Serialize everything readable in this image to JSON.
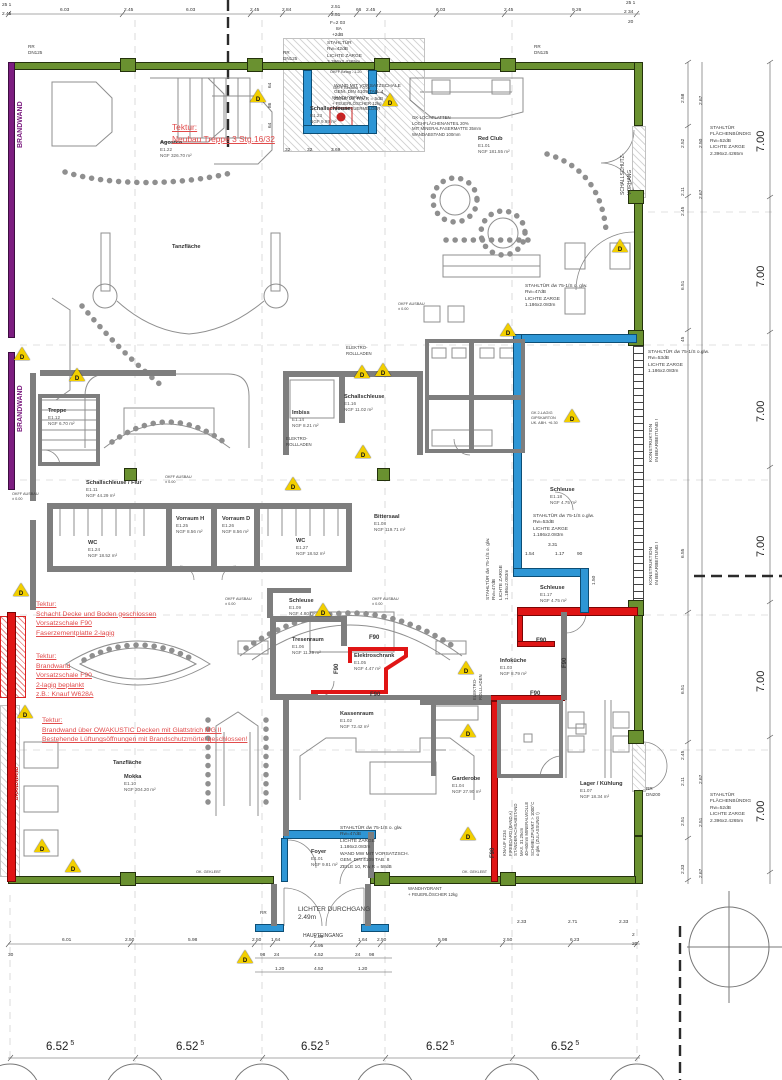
{
  "plan": {
    "colors": {
      "wall_green": "#6a9130",
      "brandwand_purple": "#7c1d80",
      "fire_red": "#e01515",
      "door_blue": "#2e96d5",
      "wall_gray": "#7e7e7e",
      "tektur_red": "#e14b4b",
      "warn_yellow": "#f2cf00"
    },
    "rooms": [
      {
        "name": "Agostea",
        "id": "E1.22",
        "area": "NGF  326.70 m²",
        "x": 160,
        "y": 140
      },
      {
        "name": "Red Club",
        "id": "E1.01",
        "area": "NGF  181.55 m²",
        "x": 478,
        "y": 136
      },
      {
        "name": "Tanzfläche",
        "id": "",
        "area": "",
        "x": 172,
        "y": 244
      },
      {
        "name": "Schallschleuse",
        "id": "E1.23",
        "area": "NGF  9.99 m²",
        "x": 310,
        "y": 106
      },
      {
        "name": "Treppe",
        "id": "E1.12",
        "area": "NGF  6.70 m²",
        "x": 48,
        "y": 408
      },
      {
        "name": "Imbiss",
        "id": "E1.14",
        "area": "NGF  8.21 m²",
        "x": 292,
        "y": 410
      },
      {
        "name": "Schallschleuse",
        "id": "E1.16",
        "area": "NGF  11.02 m²",
        "x": 344,
        "y": 394
      },
      {
        "name": "Schallschleuse / Flur",
        "id": "E1.11",
        "area": "NGF  44.29 m²",
        "x": 86,
        "y": 480
      },
      {
        "name": "Vorraum H",
        "id": "E1.25",
        "area": "NGF  8.56 m²",
        "x": 176,
        "y": 516
      },
      {
        "name": "Vorraum D",
        "id": "E1.26",
        "area": "NGF  8.56 m²",
        "x": 222,
        "y": 516
      },
      {
        "name": "WC",
        "id": "E1.24",
        "area": "NGF  18.52 m²",
        "x": 88,
        "y": 540
      },
      {
        "name": "WC",
        "id": "E1.27",
        "area": "NGF  18.52 m²",
        "x": 296,
        "y": 538
      },
      {
        "name": "Bittersaal",
        "id": "E1.08",
        "area": "NGF  119.71 m²",
        "x": 374,
        "y": 514
      },
      {
        "name": "Schleuse",
        "id": "E1.09",
        "area": "NGF  4.80 m²",
        "x": 289,
        "y": 598
      },
      {
        "name": "Schleuse",
        "id": "E1.18",
        "area": "NGF  4.75 m²",
        "x": 550,
        "y": 487
      },
      {
        "name": "Schleuse",
        "id": "E1.17",
        "area": "NGF  4.75 m²",
        "x": 540,
        "y": 585
      },
      {
        "name": "Tresenraum",
        "id": "E1.06",
        "area": "NGF  11.29 m²",
        "x": 292,
        "y": 637
      },
      {
        "name": "Elektroschrank",
        "id": "E1.05",
        "area": "NGF  4.47 m²",
        "x": 354,
        "y": 653
      },
      {
        "name": "Infoküche",
        "id": "E1.03",
        "area": "NGF  8.79 m²",
        "x": 500,
        "y": 658
      },
      {
        "name": "Kassenraum",
        "id": "E1.02",
        "area": "NGF  72.42 m²",
        "x": 340,
        "y": 711
      },
      {
        "name": "Tanzfläche",
        "id": "",
        "area": "",
        "x": 113,
        "y": 760
      },
      {
        "name": "Mokka",
        "id": "E1.10",
        "area": "NGF  204.20 m²",
        "x": 124,
        "y": 774
      },
      {
        "name": "Foyer",
        "id": "E1.01",
        "area": "NGF  9.81 m²",
        "x": 311,
        "y": 849
      },
      {
        "name": "Garderobe",
        "id": "E1.04",
        "area": "NGF  27.90 m²",
        "x": 452,
        "y": 776
      },
      {
        "name": "Lager / Kühlung",
        "id": "E1.07",
        "area": "NGF  18.34 m²",
        "x": 580,
        "y": 781
      }
    ],
    "tektur_notes": [
      {
        "x": 172,
        "y": 122,
        "big": true,
        "lines": [
          "Tektur:",
          "Neubau Treppe 3 Stg.16/32"
        ]
      },
      {
        "x": 36,
        "y": 600,
        "big": false,
        "lines": [
          "Tektur:",
          "Schacht Decke und Boden geschlossen",
          "Vorsatzschale F90",
          "Faserzementplatte 2-lagig"
        ]
      },
      {
        "x": 36,
        "y": 652,
        "big": false,
        "lines": [
          "Tektur:",
          "Brandwand",
          "Vorsatzschale F90",
          "2-lagig beplankt",
          "z.B.: Knauf W628A"
        ]
      },
      {
        "x": 42,
        "y": 716,
        "big": false,
        "lines": [
          "Tektur:",
          "Brandwand über OWAKUSTIC Decken mit Glattstrich MG II",
          "Bestehende Lüftungsöffnungen mit Brandschutzmörtel geschlossen!"
        ]
      }
    ],
    "door_specs": [
      {
        "x": 327,
        "y": 41,
        "r": 0,
        "lines": [
          "STAHLTÜR",
          "Rw=42dB",
          "LICHTE ZARGE",
          "2.396x2.4265m"
        ]
      },
      {
        "x": 710,
        "y": 126,
        "r": 0,
        "lines": [
          "STAHLTÜR",
          "FLÄCHENBÜNDIG",
          "Rw=52dB",
          "LICHTE ZARGE",
          "2.396x2.4265m"
        ]
      },
      {
        "x": 525,
        "y": 284,
        "r": 0,
        "lines": [
          "STAHLTÜR dw 75-1/S o. glw.",
          "Rw=47dB",
          "LICHTE ZARGE",
          "1.186x2.083m"
        ]
      },
      {
        "x": 648,
        "y": 350,
        "r": 0,
        "lines": [
          "STAHLTÜR dw 75-1/S o.glw.",
          "Rw=53dB",
          "LICHTE ZARGE",
          "1.186x2.083m"
        ]
      },
      {
        "x": 533,
        "y": 514,
        "r": 0,
        "lines": [
          "STAHLTÜR dw 75-1/S o.glw.",
          "Rw=53dB",
          "LICHTE ZARGE",
          "1.186x2.083m"
        ]
      },
      {
        "x": 486,
        "y": 600,
        "r": -90,
        "lines": [
          "STAHLTÜR dw 75-1/S o. glw.",
          "Rw=47dB",
          "LICHTE ZARGE",
          "1.186x2.083m"
        ]
      },
      {
        "x": 340,
        "y": 826,
        "r": 0,
        "lines": [
          "STAHLTÜR dw 75-1/S o. glw.",
          "Rw=47dB",
          "LICHTE ZARGE",
          "1.186x2.083m",
          "WAND MW MIT VORSATZSCH.",
          "GEM. DIN 4109 TAB. 8",
          "ZEILE 10, R'w,R = 58dB"
        ]
      },
      {
        "x": 710,
        "y": 793,
        "r": 0,
        "lines": [
          "STAHLTÜR",
          "FLÄCHENBÜNDIG",
          "Rw=52dB",
          "LICHTE ZARGE",
          "2.396x2.4265m"
        ]
      },
      {
        "x": 334,
        "y": 84,
        "r": 0,
        "lines": [
          "WAND MIT VORSATZSCHALE",
          "GEM. DIN 4109 TAB. 4",
          "ZEILE 10, R'w,R = 5dB"
        ]
      }
    ],
    "misc_labels": [
      {
        "lines": [
          "RR",
          "DN125"
        ],
        "x": 28,
        "y": 44,
        "r": 0,
        "c": "",
        "s": 4.6
      },
      {
        "lines": [
          "RR",
          "DN125"
        ],
        "x": 283,
        "y": 50,
        "r": 0,
        "c": "",
        "s": 4.6
      },
      {
        "lines": [
          "RR",
          "DN125"
        ],
        "x": 534,
        "y": 44,
        "r": 0,
        "c": "",
        "s": 4.6
      },
      {
        "lines": [
          "RR",
          "DN200"
        ],
        "x": 646,
        "y": 786,
        "r": 0,
        "c": "",
        "s": 4.6
      },
      {
        "lines": [
          "RR"
        ],
        "x": 260,
        "y": 910,
        "r": 0,
        "c": "",
        "s": 4.6
      },
      {
        "lines": [
          "LICHTER DURCHGANG",
          "2.49m"
        ],
        "x": 298,
        "y": 906,
        "r": 0,
        "c": "",
        "s": 6.5
      },
      {
        "lines": [
          "HAUPTEINGANG"
        ],
        "x": 303,
        "y": 933,
        "r": 0,
        "c": "",
        "s": 5
      },
      {
        "lines": [
          "WANDHYDRANT",
          "+ FEUERLÖSCHER 12kg"
        ],
        "x": 408,
        "y": 886,
        "r": 0,
        "c": "",
        "s": 4.3
      },
      {
        "lines": [
          "WANDHYDRANT",
          "+ FEUERLÖSCHER 12kg",
          "+ HANDFEUERMELDER"
        ],
        "x": 332,
        "y": 95,
        "r": 0,
        "c": "",
        "s": 4.3
      },
      {
        "lines": [
          "GK-LOCHPLATTEN",
          "LOCHFLÄCHENANTEIL 20%",
          "MIT MINERALFASERMATTE 35mm",
          "WANDABSTAND 100mm"
        ],
        "x": 412,
        "y": 115,
        "r": 0,
        "c": "",
        "s": 4.3
      },
      {
        "lines": [
          "ELEKTRO-",
          "ROLLLADEN"
        ],
        "x": 346,
        "y": 345,
        "r": 0,
        "c": "",
        "s": 4.3
      },
      {
        "lines": [
          "ELEKTRO-",
          "ROLLLADEN"
        ],
        "x": 286,
        "y": 436,
        "r": 0,
        "c": "",
        "s": 4.3
      },
      {
        "lines": [
          "ELEKTRO-",
          "ROLLLADEN"
        ],
        "x": 472,
        "y": 700,
        "r": -90,
        "c": "",
        "s": 4.3
      },
      {
        "lines": [
          "SCHALLSCHUTZ-",
          "VORHANG"
        ],
        "x": 620,
        "y": 195,
        "r": -90,
        "c": "",
        "s": 5
      },
      {
        "lines": [
          "KONSTRUKTION",
          "IN BEARBEITUNG !"
        ],
        "x": 649,
        "y": 462,
        "r": -90,
        "c": "",
        "s": 4.8
      },
      {
        "lines": [
          "KONSTRUKTION",
          "IN BEARBEITUNG !"
        ],
        "x": 649,
        "y": 585,
        "r": -90,
        "c": "",
        "s": 4.8
      },
      {
        "lines": [
          "BRANDWAND"
        ],
        "x": 16,
        "y": 148,
        "r": -90,
        "c": "#7c1d80",
        "s": 7
      },
      {
        "lines": [
          "BRANDWAND"
        ],
        "x": 16,
        "y": 432,
        "r": -90,
        "c": "#7c1d80",
        "s": 7
      },
      {
        "lines": [
          "BRANDWAND"
        ],
        "x": 14,
        "y": 800,
        "r": -90,
        "c": "#d01414",
        "s": 5
      },
      {
        "lines": [
          "OK. GEKLEBT"
        ],
        "x": 196,
        "y": 870,
        "r": 0,
        "c": "",
        "s": 3.8
      },
      {
        "lines": [
          "OK. GEKLEBT"
        ],
        "x": 462,
        "y": 870,
        "r": 0,
        "c": "",
        "s": 3.8
      },
      {
        "lines": [
          "OKFF AUSBAU",
          "± 0.00"
        ],
        "x": 165,
        "y": 475,
        "r": 0,
        "c": "",
        "s": 3.8
      },
      {
        "lines": [
          "OKFF AUSBAU",
          "± 0.00"
        ],
        "x": 12,
        "y": 492,
        "r": 0,
        "c": "",
        "s": 3.8
      },
      {
        "lines": [
          "OKFF AUSBAU",
          "± 0.00"
        ],
        "x": 225,
        "y": 597,
        "r": 0,
        "c": "",
        "s": 3.8
      },
      {
        "lines": [
          "OKFF AUSBAU",
          "± 0.00"
        ],
        "x": 372,
        "y": 597,
        "r": 0,
        "c": "",
        "s": 3.8
      },
      {
        "lines": [
          "OKFF AUSBAU",
          "± 0.00"
        ],
        "x": 398,
        "y": 302,
        "r": 0,
        "c": "",
        "s": 3.8
      },
      {
        "lines": [
          "OKFF Belag  - 1.20"
        ],
        "x": 330,
        "y": 70,
        "r": 0,
        "c": "",
        "s": 3.8
      },
      {
        "lines": [
          "OKFF Bestand  + 0.06"
        ],
        "x": 333,
        "y": 86,
        "r": 0,
        "c": "",
        "s": 3.8
      },
      {
        "lines": [
          "GK 2-LAGIG",
          "GIPSKARTON",
          "UK. ABH. +6.30"
        ],
        "x": 531,
        "y": 411,
        "r": 0,
        "c": "",
        "s": 3.8
      },
      {
        "lines": [
          "KNAUF K234",
          "FIREBOARD (BAND A)",
          "STÄNDERACHSABSTAND",
          "MAX. 31.25cm",
          "40+60mm MINERALWOLLE",
          "SCHMELZPUNKT > 1000°C",
          "o.glw. (ZULASSUNG !)"
        ],
        "x": 502,
        "y": 856,
        "r": -90,
        "c": "",
        "s": 4.3
      }
    ],
    "f90": {
      "text": "F90",
      "items": [
        {
          "x": 369,
          "y": 635,
          "r": 0
        },
        {
          "x": 334,
          "y": 674,
          "r": -90
        },
        {
          "x": 370,
          "y": 692,
          "r": 0
        },
        {
          "x": 536,
          "y": 638,
          "r": 0
        },
        {
          "x": 530,
          "y": 691,
          "r": 0
        },
        {
          "x": 562,
          "y": 668,
          "r": -90
        },
        {
          "x": 490,
          "y": 858,
          "r": -90
        }
      ]
    },
    "warn": {
      "letter": "D",
      "items": [
        [
          258,
          96
        ],
        [
          390,
          100
        ],
        [
          22,
          354
        ],
        [
          77,
          375
        ],
        [
          362,
          372
        ],
        [
          383,
          370
        ],
        [
          620,
          246
        ],
        [
          508,
          330
        ],
        [
          572,
          416
        ],
        [
          363,
          452
        ],
        [
          293,
          484
        ],
        [
          21,
          590
        ],
        [
          323,
          610
        ],
        [
          466,
          668
        ],
        [
          25,
          712
        ],
        [
          468,
          731
        ],
        [
          42,
          846
        ],
        [
          73,
          866
        ],
        [
          468,
          834
        ],
        [
          245,
          957
        ]
      ]
    },
    "dims": [
      {
        "t": "25 1",
        "x": 2,
        "y": 3
      },
      {
        "t": "2.45",
        "x": 2,
        "y": 12
      },
      {
        "t": "6.03",
        "x": 60,
        "y": 8
      },
      {
        "t": "2.45",
        "x": 124,
        "y": 8
      },
      {
        "t": "6.03",
        "x": 186,
        "y": 8
      },
      {
        "t": "2.45",
        "x": 250,
        "y": 8
      },
      {
        "t": "2.84",
        "x": 282,
        "y": 8
      },
      {
        "t": "2.51",
        "x": 331,
        "y": 5
      },
      {
        "t": "2.51",
        "x": 331,
        "y": 13
      },
      {
        "t": "F=2 03",
        "x": 330,
        "y": 21
      },
      {
        "t": "8A",
        "x": 336,
        "y": 27
      },
      {
        "t": "+2dB",
        "x": 332,
        "y": 33
      },
      {
        "t": "66",
        "x": 356,
        "y": 8
      },
      {
        "t": "2.45",
        "x": 366,
        "y": 8
      },
      {
        "t": "6.03",
        "x": 436,
        "y": 8
      },
      {
        "t": "2.45",
        "x": 504,
        "y": 8
      },
      {
        "t": "9.26",
        "x": 572,
        "y": 8
      },
      {
        "t": "25 1",
        "x": 626,
        "y": 1
      },
      {
        "t": "2 34",
        "x": 624,
        "y": 10
      },
      {
        "t": "20",
        "x": 628,
        "y": 20
      },
      {
        "t": "6.01",
        "x": 62,
        "y": 938
      },
      {
        "t": "2.50",
        "x": 125,
        "y": 938
      },
      {
        "t": "5.98",
        "x": 188,
        "y": 938
      },
      {
        "t": "2.50",
        "x": 252,
        "y": 938
      },
      {
        "t": "1.64",
        "x": 271,
        "y": 938
      },
      {
        "t": "2.69",
        "x": 314,
        "y": 935
      },
      {
        "t": "3.95",
        "x": 314,
        "y": 944
      },
      {
        "t": "1.64",
        "x": 358,
        "y": 938
      },
      {
        "t": "2.50",
        "x": 377,
        "y": 938
      },
      {
        "t": "5.98",
        "x": 438,
        "y": 938
      },
      {
        "t": "2.50",
        "x": 503,
        "y": 938
      },
      {
        "t": "6.23",
        "x": 570,
        "y": 938
      },
      {
        "t": "2",
        "x": 632,
        "y": 933
      },
      {
        "t": "20",
        "x": 632,
        "y": 942
      },
      {
        "t": "30",
        "x": 8,
        "y": 953
      },
      {
        "t": "98",
        "x": 260,
        "y": 953
      },
      {
        "t": "24",
        "x": 274,
        "y": 953
      },
      {
        "t": "4.52",
        "x": 314,
        "y": 953
      },
      {
        "t": "24",
        "x": 355,
        "y": 953
      },
      {
        "t": "98",
        "x": 369,
        "y": 953
      },
      {
        "t": "1.20",
        "x": 275,
        "y": 967
      },
      {
        "t": "4.52",
        "x": 314,
        "y": 967
      },
      {
        "t": "1.20",
        "x": 358,
        "y": 967
      },
      {
        "t": "32",
        "x": 285,
        "y": 148
      },
      {
        "t": "3.69",
        "x": 331,
        "y": 148
      },
      {
        "t": "32",
        "x": 307,
        "y": 148
      },
      {
        "t": "3.31",
        "x": 548,
        "y": 543
      },
      {
        "t": "1.54",
        "x": 525,
        "y": 552
      },
      {
        "t": "1.17",
        "x": 555,
        "y": 552
      },
      {
        "t": "90",
        "x": 577,
        "y": 552
      },
      {
        "t": "1.50",
        "x": 592,
        "y": 585,
        "r": -90
      },
      {
        "t": "2.33",
        "x": 517,
        "y": 920
      },
      {
        "t": "2.71",
        "x": 568,
        "y": 920
      },
      {
        "t": "2.33",
        "x": 619,
        "y": 920
      },
      {
        "t": "64",
        "x": 268,
        "y": 88,
        "r": -90
      },
      {
        "t": "86",
        "x": 268,
        "y": 108,
        "r": -90
      },
      {
        "t": "64",
        "x": 268,
        "y": 128,
        "r": -90
      },
      {
        "t": "2.58",
        "x": 681,
        "y": 103,
        "r": -90
      },
      {
        "t": "2.67",
        "x": 699,
        "y": 105,
        "r": -90
      },
      {
        "t": "2.52",
        "x": 681,
        "y": 148,
        "r": -90
      },
      {
        "t": "2.50",
        "x": 699,
        "y": 148,
        "r": -90
      },
      {
        "t": "2.11",
        "x": 681,
        "y": 196,
        "r": -90
      },
      {
        "t": "2.67",
        "x": 699,
        "y": 199,
        "r": -90
      },
      {
        "t": "2.45",
        "x": 681,
        "y": 216,
        "r": -90
      },
      {
        "t": "6.51",
        "x": 681,
        "y": 290,
        "r": -90
      },
      {
        "t": "45",
        "x": 681,
        "y": 342,
        "r": -90
      },
      {
        "t": "6.55",
        "x": 681,
        "y": 558,
        "r": -90
      },
      {
        "t": "6.51",
        "x": 681,
        "y": 694,
        "r": -90
      },
      {
        "t": "2.45",
        "x": 681,
        "y": 760,
        "r": -90
      },
      {
        "t": "2.11",
        "x": 681,
        "y": 786,
        "r": -90
      },
      {
        "t": "2.67",
        "x": 699,
        "y": 784,
        "r": -90
      },
      {
        "t": "2.51",
        "x": 681,
        "y": 826,
        "r": -90
      },
      {
        "t": "2.51",
        "x": 699,
        "y": 827,
        "r": -90
      },
      {
        "t": "2.33",
        "x": 681,
        "y": 874,
        "r": -90
      },
      {
        "t": "2.67",
        "x": 699,
        "y": 878,
        "r": -90
      }
    ],
    "big_dims": {
      "text": "7.00",
      "x": 755,
      "ys": [
        152,
        287,
        422,
        557,
        692,
        822
      ]
    },
    "grid_spans": {
      "text": "6.52",
      "sup": "5",
      "y": 1040,
      "xs": [
        46,
        176,
        301,
        426,
        551
      ]
    }
  }
}
